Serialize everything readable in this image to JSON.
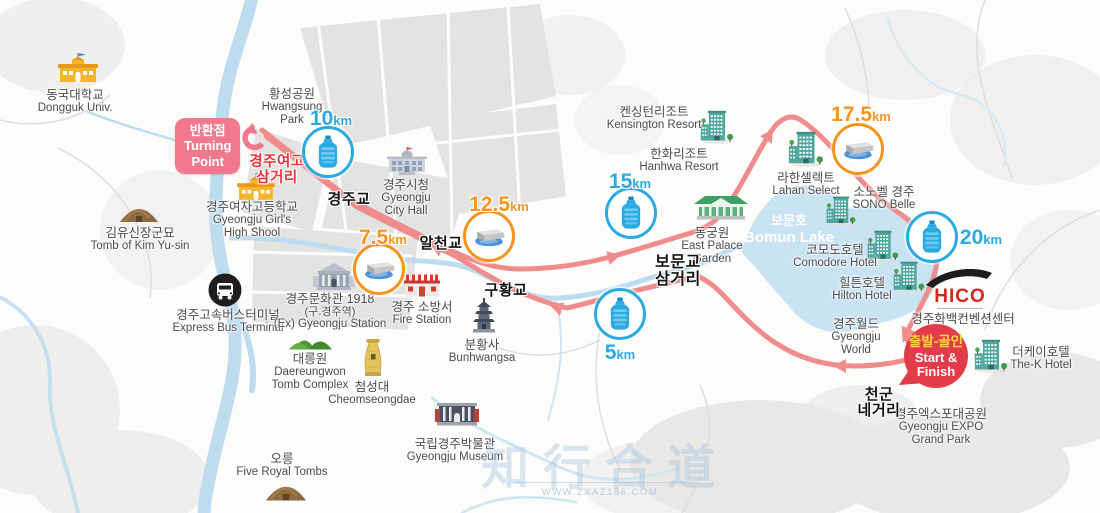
{
  "badges": {
    "turning": {
      "ko": "반환점",
      "en1": "Turning",
      "en2": "Point"
    },
    "start": {
      "ko": "출발-골인",
      "en1": "Start &",
      "en2": "Finish"
    }
  },
  "km": {
    "k5": {
      "num": "5",
      "unit": "km"
    },
    "k75": {
      "num": "7.5",
      "unit": "km"
    },
    "k10": {
      "num": "10",
      "unit": "km"
    },
    "k125": {
      "num": "12.5",
      "unit": "km"
    },
    "k15": {
      "num": "15",
      "unit": "km"
    },
    "k175": {
      "num": "17.5",
      "unit": "km"
    },
    "k20": {
      "num": "20",
      "unit": "km"
    }
  },
  "roads": {
    "gyeongjugyo": "경주교",
    "alcheongyo": "알천교",
    "guhwanggyo": "구황교",
    "bomun1": "보문교",
    "bomun2": "삼거리",
    "cheongun1": "천군",
    "cheongun2": "네거리",
    "yeogo1": "경주여고",
    "yeogo2": "삼거리"
  },
  "lake": {
    "ko": "보문호",
    "en": "Bomun Lake"
  },
  "landmarks": {
    "dongguk": {
      "ko": "동국대학교",
      "en": "Dongguk Univ."
    },
    "hwangsung": {
      "ko": "황성공원",
      "en1": "Hwangsung",
      "en2": "Park"
    },
    "girlshigh": {
      "ko": "경주여자고등학교",
      "en1": "Gyeongju Girl's",
      "en2": "High Shool"
    },
    "kimyusin": {
      "ko": "김유신장군묘",
      "en": "Tomb of Kim Yu-sin"
    },
    "cityhall": {
      "ko": "경주시청",
      "en1": "Gyeongju",
      "en2": "City Hall"
    },
    "busterminal": {
      "ko": "경주고속버스터미널",
      "en": "Express Bus Terminal"
    },
    "culturehall": {
      "ko": "경주문화관 1918",
      "ko2": "(구.경주역)",
      "en": "(Ex) Gyeongju Station"
    },
    "firestation": {
      "ko": "경주 소방서",
      "en": "Fire Station"
    },
    "bunhwangsa": {
      "ko": "분황사",
      "en": "Bunhwangsa"
    },
    "daereungwon": {
      "ko": "대릉원",
      "en1": "Daereungwon",
      "en2": "Tomb Complex"
    },
    "cheomseongdae": {
      "ko": "첨성대",
      "en": "Cheomseongdae"
    },
    "fivetombs": {
      "ko": "오릉",
      "en": "Five Royal Tombs"
    },
    "museum": {
      "ko": "국립경주박물관",
      "en": "Gyeongju Museum"
    },
    "kensington": {
      "ko": "켄싱턴리조트",
      "en": "Kensington Resort"
    },
    "hanhwa": {
      "ko": "한화리조트",
      "en": "Hanhwa Resort"
    },
    "eastpalace": {
      "ko": "동궁원",
      "en1": "East Palace",
      "en2": "Garden"
    },
    "lahan": {
      "ko": "라한셀렉트",
      "en": "Lahan Select"
    },
    "sono": {
      "ko": "소노벨 경주",
      "en": "SONO Belle"
    },
    "comodore": {
      "ko": "코모도호텔",
      "en": "Comodore Hotel"
    },
    "hilton": {
      "ko": "힐튼호텔",
      "en": "Hilton Hotel"
    },
    "world": {
      "ko": "경주월드",
      "en1": "Gyeongju",
      "en2": "World"
    },
    "hico": {
      "logo": "HICO",
      "ko": "경주화백컨벤션센터"
    },
    "thek": {
      "ko": "더케이호텔",
      "en": "The-K Hotel"
    },
    "expo": {
      "ko": "경주엑스포대공원",
      "en1": "Gyeongju EXPO",
      "en2": "Grand Park"
    }
  },
  "watermark": {
    "title": "知行合道",
    "url": "WWW.ZXAZ186.COM"
  },
  "colors": {
    "route": "#F08C8C",
    "water": "#BDDCF0",
    "lake": "#C9E3F4",
    "km_blue": "#29ABE2",
    "km_orange": "#F7941D",
    "badge_pink": "#F2798D",
    "badge_red": "#E23B4A",
    "badge_yellow": "#FFD83D",
    "road_label": "#141414",
    "junction_red": "#E8323C",
    "hico_red": "#D3281E",
    "label_gray": "#4B4C4E",
    "hotel_teal": "#4FA79E"
  }
}
